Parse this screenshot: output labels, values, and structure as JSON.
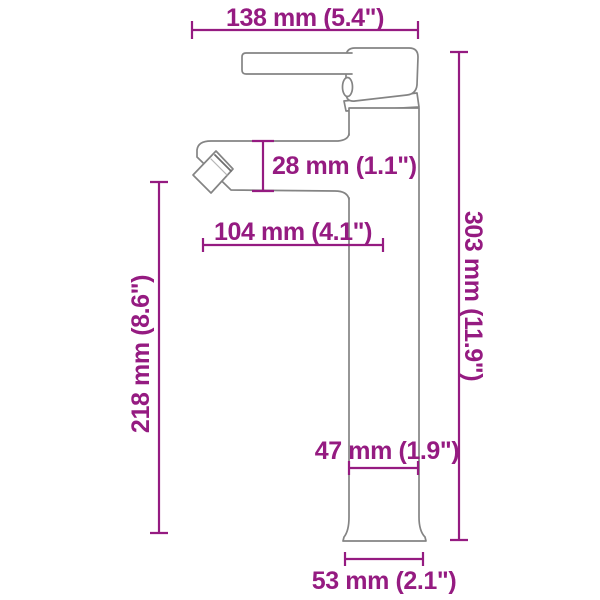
{
  "diagram": {
    "kind": "product-dimension-drawing",
    "colors": {
      "dimension_accent": "#951B81",
      "drawing_outline": "#848484",
      "background": "#FFFFFF"
    },
    "dimensions": {
      "total_width": {
        "label": "138 mm (5.4\")"
      },
      "spout_height": {
        "label": "28 mm (1.1\")"
      },
      "spout_reach": {
        "label": "104 mm (4.1\")"
      },
      "outlet_height": {
        "label": "218 mm (8.6\")"
      },
      "total_height": {
        "label": "303 mm (11.9\")"
      },
      "body_width": {
        "label": "47 mm (1.9\")"
      },
      "base_width": {
        "label": "53 mm (2.1\")"
      }
    }
  }
}
